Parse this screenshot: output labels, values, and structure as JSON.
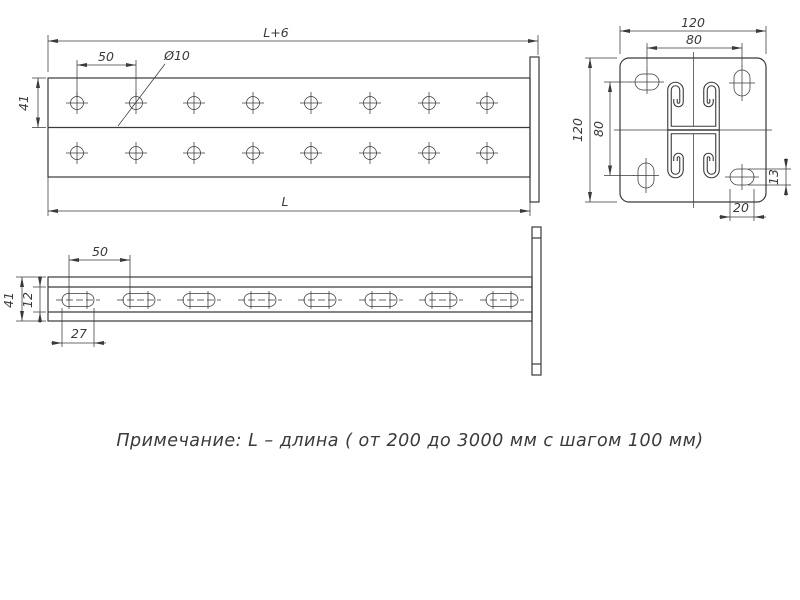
{
  "colors": {
    "line": "#3a3a3a",
    "bg": "#ffffff"
  },
  "plan_view": {
    "dim_total_length": "L+6",
    "dim_hole_pitch": "50",
    "dim_hole_diameter": "Ø10",
    "dim_channel_width": "41",
    "dim_length": "L"
  },
  "side_view": {
    "dim_slot_pitch": "50",
    "dim_height": "41",
    "dim_slot_height": "12",
    "dim_slot_length": "27"
  },
  "end_view": {
    "dim_plate_width": "120",
    "dim_bolt_spacing_horizontal": "80",
    "dim_plate_height": "120",
    "dim_bolt_spacing_vertical": "80",
    "dim_corner_slot_height": "13",
    "dim_corner_slot_width": "20"
  },
  "note": {
    "text": "Примечание: L – длина ( от 200 до 3000 мм с шагом 100 мм)"
  }
}
